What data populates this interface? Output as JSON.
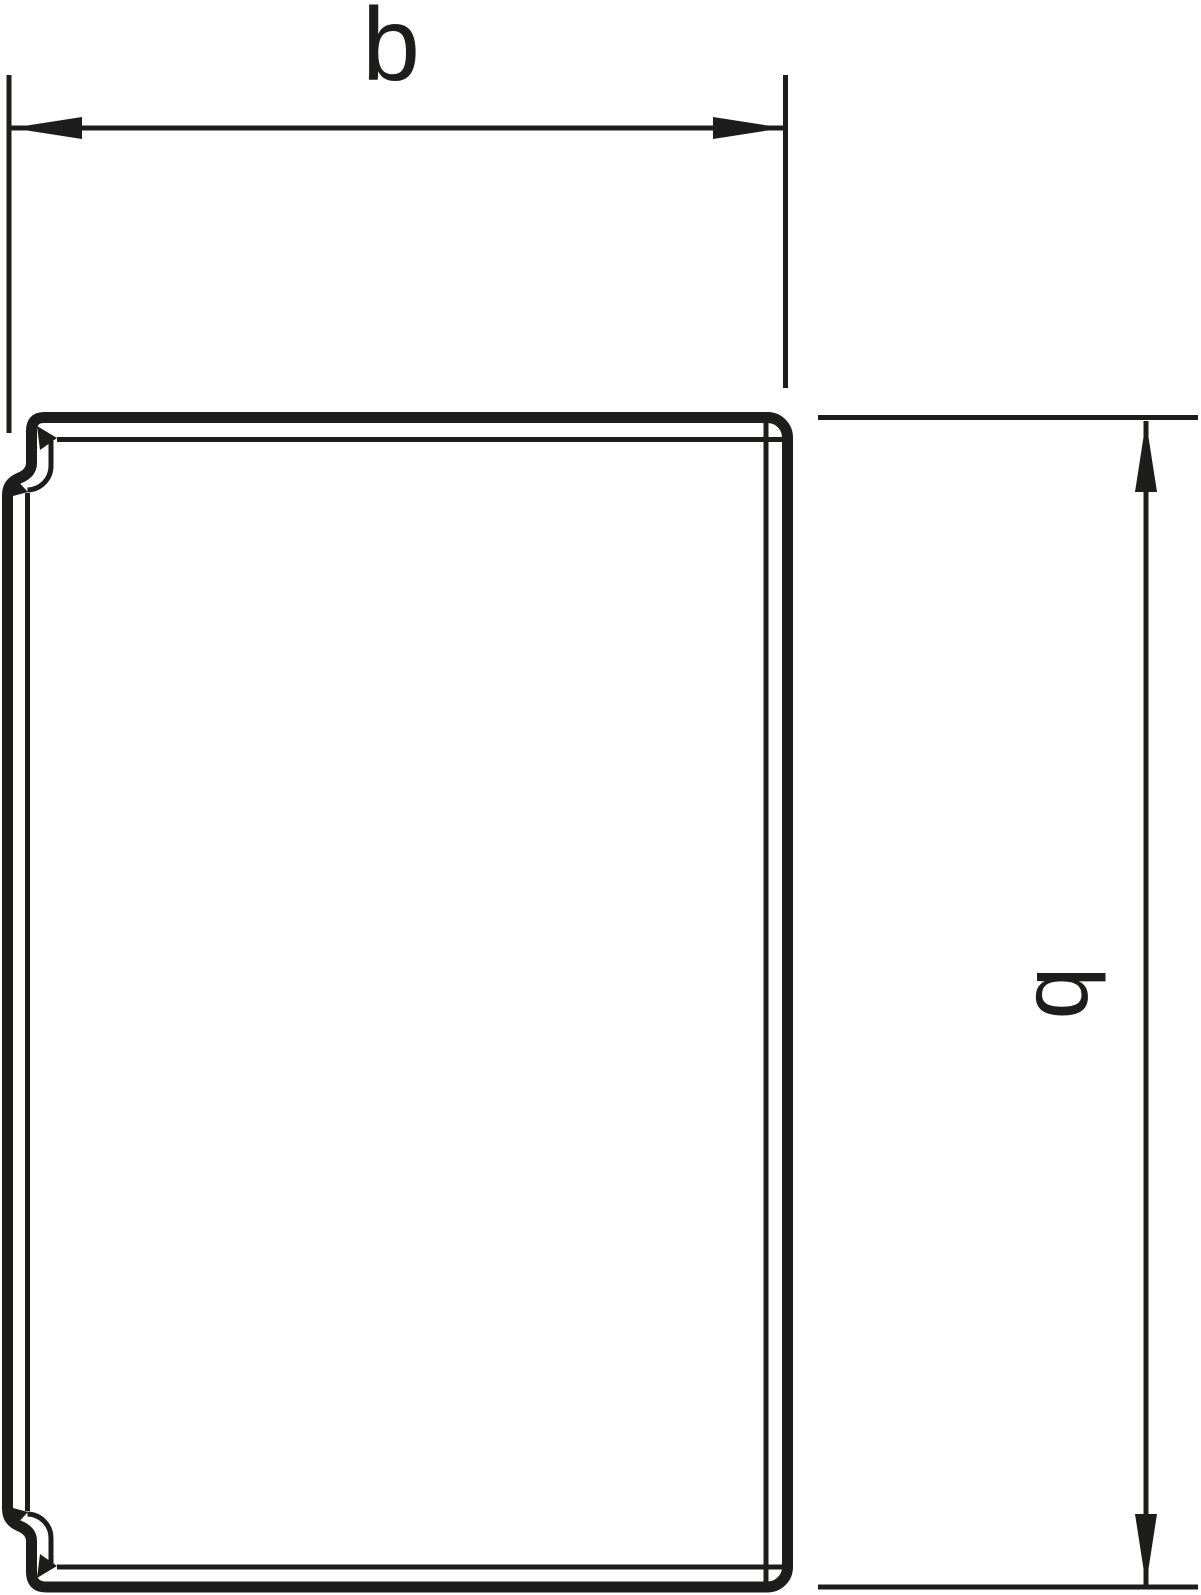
{
  "drawing": {
    "kind": "technical-line-drawing",
    "subject": "duct-profile-cross-section-with-clip-hooks",
    "ink_color": "#1d1d1b",
    "background_color": "#ffffff",
    "dimension_width": {
      "label": "b",
      "orientation": "horizontal",
      "position": "top"
    },
    "dimension_height": {
      "label": "b",
      "orientation": "vertical",
      "position": "right",
      "label_rotation_deg": 90
    }
  }
}
